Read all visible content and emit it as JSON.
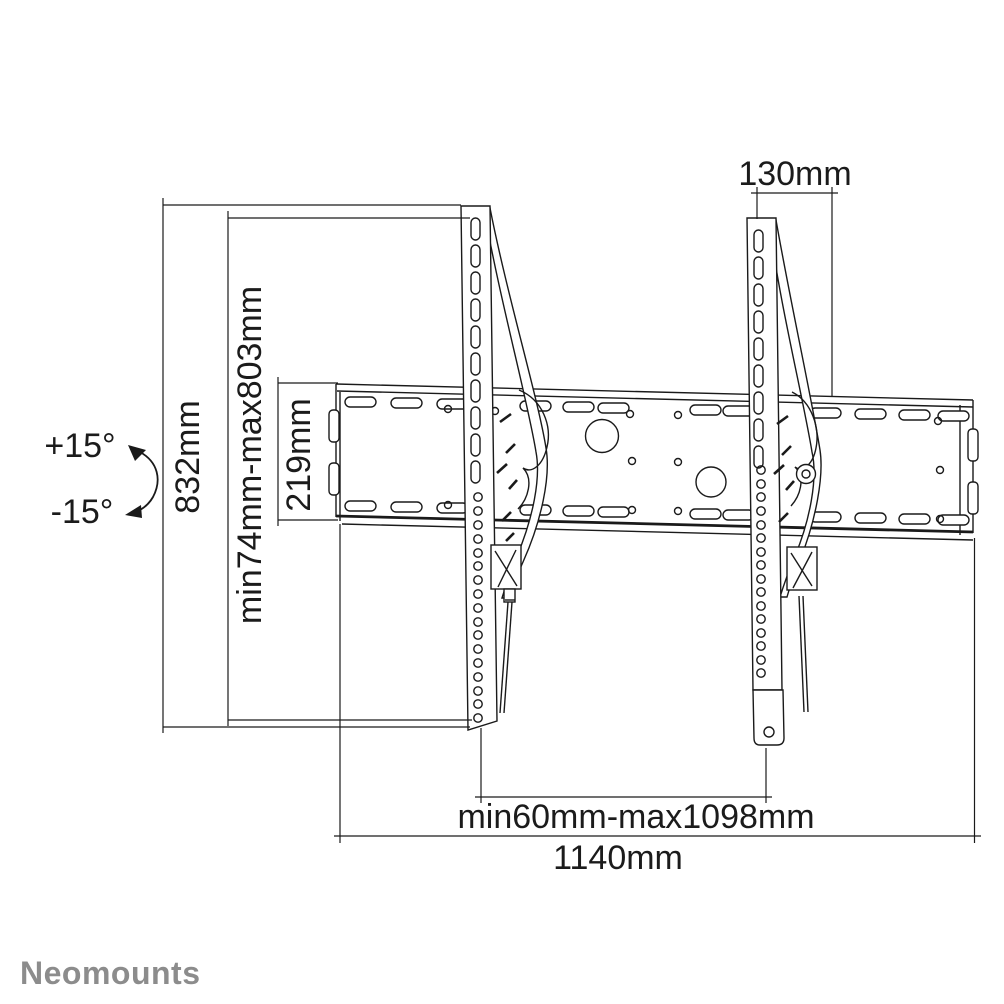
{
  "drawing": {
    "brand": "Neomounts",
    "dims": {
      "total_height": "832mm",
      "vesa_height_range": "min74mm-max803mm",
      "plate_height": "219mm",
      "bracket_width": "130mm",
      "bracket_spacing_range": "min60mm-max1098mm",
      "total_width": "1140mm",
      "tilt_positive": "+15°",
      "tilt_negative": "-15°"
    },
    "colors": {
      "line": "#1a1a1a",
      "logo": "#8c8c8c",
      "background": "#ffffff"
    }
  }
}
